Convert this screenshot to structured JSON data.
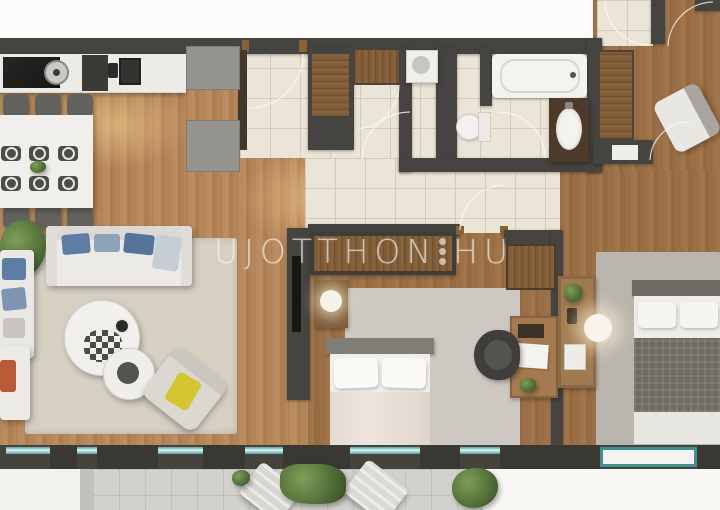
{
  "watermark": {
    "text_left": "UJOTTHON",
    "text_right": "HU",
    "separator": "three-vertical-dots",
    "dot_count": 3
  },
  "palette": {
    "wall": "#454440",
    "wood_light": "#b5885b",
    "wood_dark": "#9b6f46",
    "tile": "#ebe5d7",
    "window_glass_teal": "#4fa3a3",
    "rug_living": "#d6d0c3",
    "rug_bedroom": "#bab5ad",
    "sofa_pillow_blue": "#5d7da4",
    "armchair_pillow_yellow": "#d4c531",
    "plant_green": "#55713a",
    "wardrobe_brown": "#7a5733",
    "balcony_floor": "#d2d1ce",
    "watermark_color": "#f8f7f4",
    "door_post_brown": "#8a6335"
  },
  "scene": {
    "type": "apartment-floor-plan-render",
    "rooms": [
      "kitchen",
      "dining-area",
      "living-room",
      "entry-foyer",
      "wc",
      "bathroom",
      "bedroom-1",
      "bedroom-2",
      "study-room",
      "terrace"
    ],
    "objects": [
      "kitchen-counter",
      "cooktop",
      "kitchen-sink",
      "fridge-cabinets",
      "dining-table",
      "dining-chairs",
      "sofa",
      "coffee-tables",
      "armchairs",
      "tv-wall",
      "bathtub",
      "toilet",
      "vanity-sink",
      "washing-machine",
      "wardrobes",
      "beds",
      "nightstand-lamp",
      "desk",
      "office-chair",
      "console-shelf",
      "lounge-chairs",
      "plants",
      "window-wall"
    ]
  }
}
